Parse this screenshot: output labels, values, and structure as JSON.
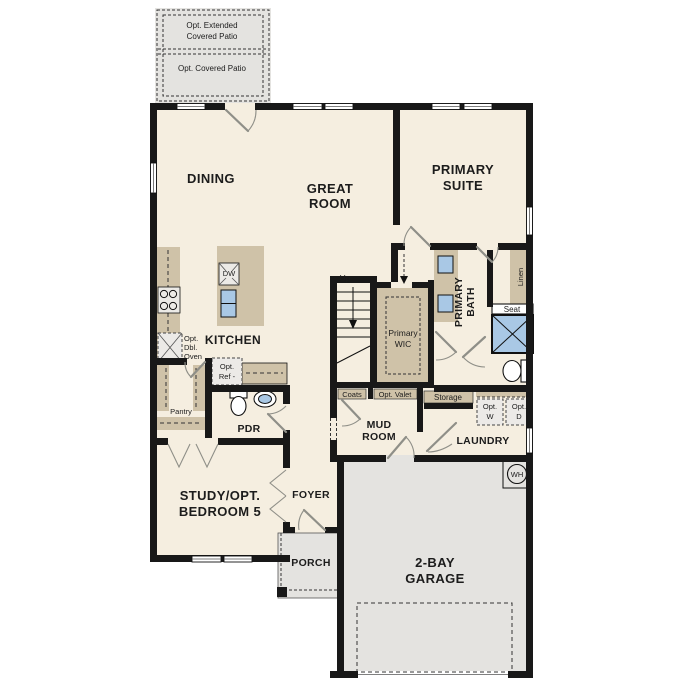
{
  "plan": {
    "colors": {
      "floor": "#f5eee0",
      "cabinetry": "#cfc2a8",
      "concrete": "#e4e3e0",
      "fixture_blue": "#a9c8e5",
      "wall": "#181818"
    },
    "rooms": {
      "dining": "DINING",
      "great_room": [
        "GREAT",
        "ROOM"
      ],
      "primary_suite": [
        "PRIMARY",
        "SUITE"
      ],
      "kitchen": "KITCHEN",
      "primary_wic": [
        "Primary",
        "WIC"
      ],
      "primary_bath": [
        "PRIMARY",
        "BATH"
      ],
      "mud_room": [
        "MUD",
        "ROOM"
      ],
      "laundry": "LAUNDRY",
      "powder": "PDR",
      "foyer": "FOYER",
      "porch": "PORCH",
      "study": [
        "STUDY/OPT.",
        "BEDROOM 5"
      ],
      "garage": [
        "2-BAY",
        "GARAGE"
      ],
      "pantry": "Pantry"
    },
    "options": {
      "extended_patio": [
        "Opt. Extended",
        "Covered Patio"
      ],
      "covered_patio": "Opt. Covered Patio",
      "dbl_oven": [
        "Opt.",
        "Dbl.",
        "Oven"
      ],
      "fridge": [
        "Opt.",
        "Ref -"
      ],
      "valet": "Opt. Valet",
      "washer": [
        "Opt.",
        "W"
      ],
      "dryer": [
        "Opt.",
        "D"
      ]
    },
    "fixtures": {
      "dishwasher": "DW",
      "water_heater": "WH",
      "stairs_up": "Up",
      "coats": "Coats",
      "storage": "Storage",
      "linen": "Linen",
      "seat": "Seat"
    }
  }
}
